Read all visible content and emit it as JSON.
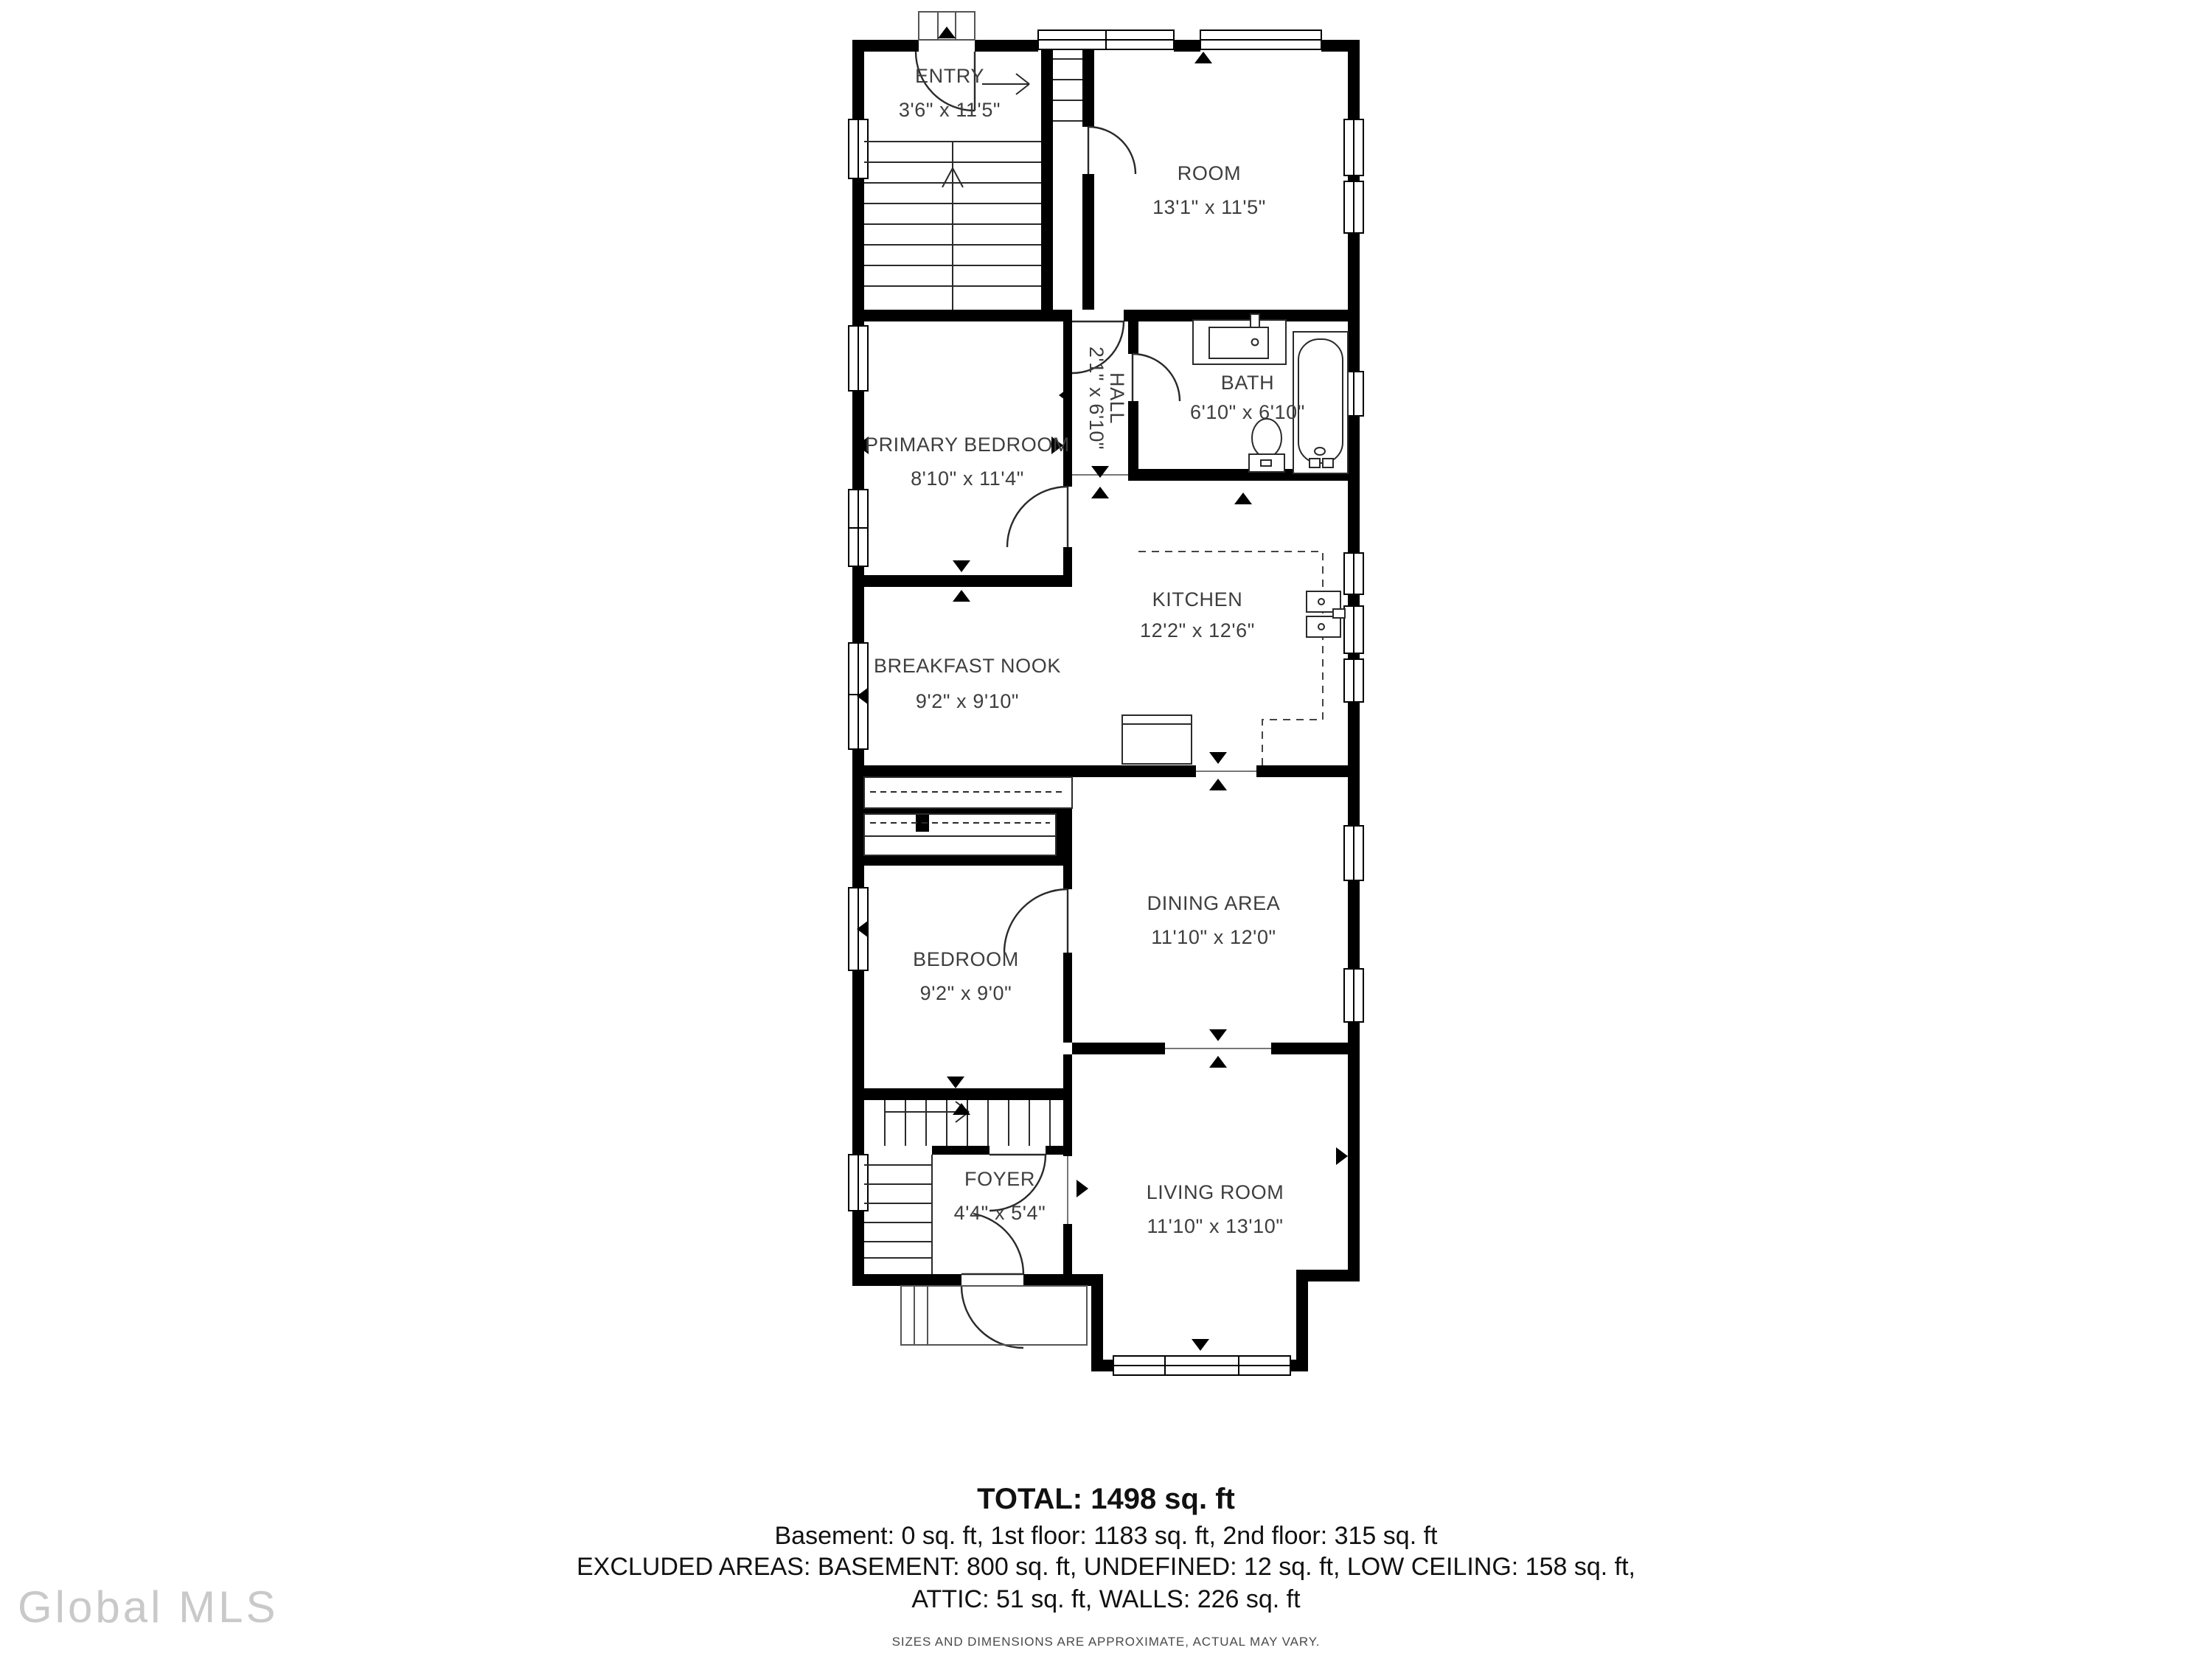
{
  "rooms": [
    {
      "id": "entry",
      "name": "ENTRY",
      "dims": "3'6\" x 11'5\""
    },
    {
      "id": "room",
      "name": "ROOM",
      "dims": "13'1\" x 11'5\""
    },
    {
      "id": "primary-bedroom",
      "name": "PRIMARY BEDROOM",
      "dims": "8'10\" x 11'4\""
    },
    {
      "id": "hall",
      "name": "HALL",
      "dims": "2'1\" x 6'10\""
    },
    {
      "id": "bath",
      "name": "BATH",
      "dims": "6'10\" x 6'10\""
    },
    {
      "id": "kitchen",
      "name": "KITCHEN",
      "dims": "12'2\" x 12'6\""
    },
    {
      "id": "breakfast-nook",
      "name": "BREAKFAST NOOK",
      "dims": "9'2\" x 9'10\""
    },
    {
      "id": "bedroom",
      "name": "BEDROOM",
      "dims": "9'2\" x 9'0\""
    },
    {
      "id": "dining-area",
      "name": "DINING AREA",
      "dims": "11'10\" x 12'0\""
    },
    {
      "id": "foyer",
      "name": "FOYER",
      "dims": "4'4\" x 5'4\""
    },
    {
      "id": "living-room",
      "name": "LIVING ROOM",
      "dims": "11'10\" x 13'10\""
    }
  ],
  "summary": {
    "total": "TOTAL: 1498 sq. ft",
    "floors": "Basement: 0 sq. ft, 1st floor: 1183 sq. ft, 2nd floor: 315 sq. ft",
    "excluded1": "EXCLUDED AREAS: BASEMENT: 800 sq. ft, UNDEFINED: 12 sq. ft, LOW CEILING: 158 sq. ft,",
    "excluded2": "ATTIC: 51 sq. ft, WALLS: 226 sq. ft",
    "disclaimer": "SIZES AND DIMENSIONS ARE APPROXIMATE, ACTUAL MAY VARY."
  },
  "watermark": {
    "text": "Global MLS"
  },
  "colors": {
    "wall": "#000000",
    "label": "#3e3e3e",
    "watermark": "#c9c9c9"
  }
}
